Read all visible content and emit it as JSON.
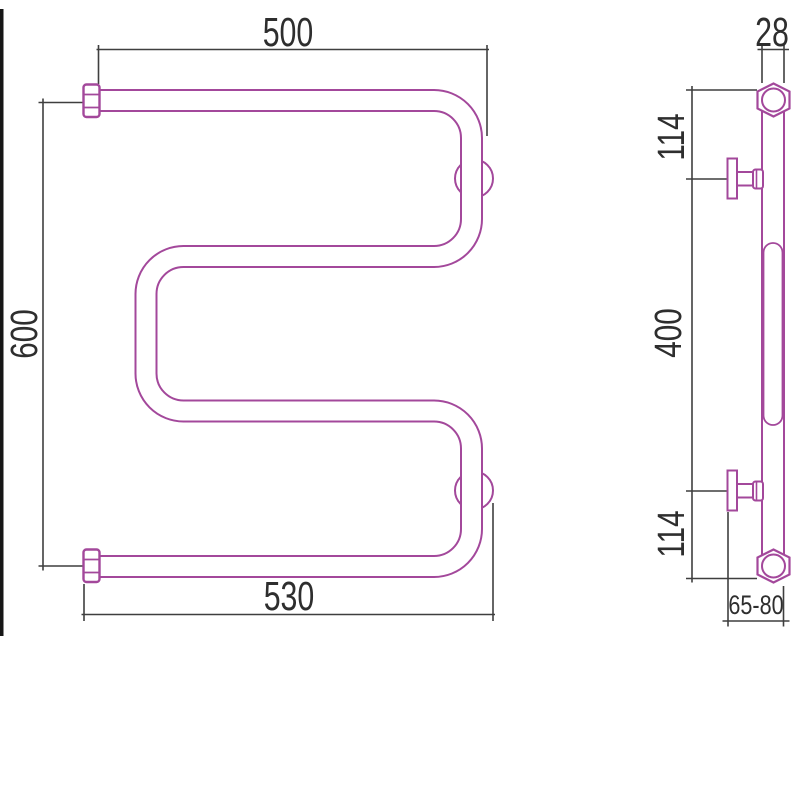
{
  "front_view": {
    "top_width_label": "500",
    "height_label": "600",
    "bottom_width_label": "530"
  },
  "side_view": {
    "pipe_width_label": "28",
    "top_spacing_label": "114",
    "bracket_spacing_label": "400",
    "bottom_spacing_label": "114",
    "wall_offset_label": "65-80"
  },
  "colors": {
    "product_line": "#a3489b",
    "dimension_line": "#3f3f3f",
    "text": "#2e2e2e",
    "edge_bar": "#161616",
    "background": "#ffffff"
  }
}
